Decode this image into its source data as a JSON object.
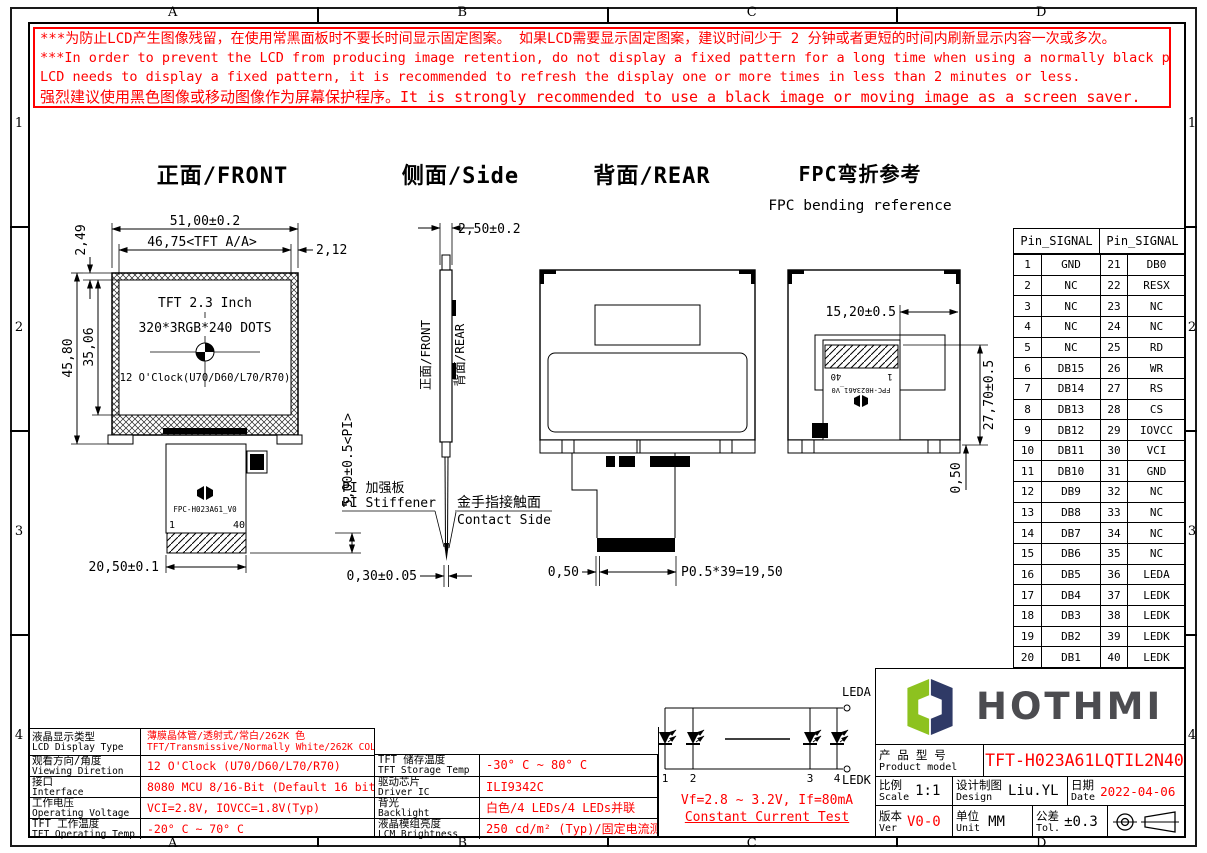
{
  "colors": {
    "red": "#ff0000",
    "black": "#000000",
    "logo_green": "#8dc21f",
    "logo_navy": "#2f3a66",
    "logo_text": "#4c4c50"
  },
  "frame": {
    "cols": [
      "A",
      "B",
      "C",
      "D"
    ],
    "rows": [
      "1",
      "2",
      "3",
      "4"
    ]
  },
  "warning": {
    "line1": "***为防止LCD产生图像残留，在使用常黑面板时不要长时间显示固定图案。 如果LCD需要显示固定图案，建议时间少于 2 分钟或者更短的时间内刷新显示内容一次或多次。",
    "line2": "***In order to prevent the LCD from producing image retention, do not display a fixed pattern for a long time when using a normally black panel. If the",
    "line3": " LCD needs to display a fixed pattern, it is recommended to refresh the display one or more times in less than 2 minutes or less.",
    "line4": "强烈建议使用黑色图像或移动图像作为屏幕保护程序。It is strongly recommended to use a black image or moving image as a screen saver."
  },
  "views": {
    "front": {
      "title": "正面/FRONT",
      "dim_width": "51,00±0.2",
      "dim_aa_width": "46,75<TFT A/A>",
      "dim_right": "2,12",
      "dim_top": "2,49",
      "dim_height": "45,80",
      "dim_aa_height": "35,06",
      "dim_fpc_width": "20,50±0.1",
      "dim_pi": "5,00±0.5<PI>",
      "panel_line1": "TFT 2.3 Inch",
      "panel_line2": "320*3RGB*240 DOTS",
      "panel_line3": "12 O'Clock(U70/D60/L70/R70)",
      "fpc_label": "FPC-H023A61_V0",
      "pin_first": "1",
      "pin_last": "40"
    },
    "side": {
      "title": "侧面/Side",
      "dim_thickness": "2,50±0.2",
      "label_front": "正面/FRONT",
      "label_rear": "背面/REAR",
      "stiffener_cn": "PI 加强板",
      "stiffener_en": "PI Stiffener",
      "contact_cn": "金手指接触面",
      "contact_en": "Contact Side",
      "dim_fpc_thickness": "0,30±0.05"
    },
    "rear": {
      "title": "背面/REAR",
      "dim_pin_offset": "0,50",
      "dim_pitch": "P0.5*39=19,50"
    },
    "fpc": {
      "title": "FPC弯折参考",
      "subtitle": "FPC bending reference",
      "dim_bend_width": "15,20±0.5",
      "dim_bend_height": "27,70±0.5",
      "dim_gap": "0,50",
      "fpc_label": "FPC-H023A61_V0",
      "pin_first": "1",
      "pin_last": "40"
    }
  },
  "pin_table": {
    "header_left": "Pin_SIGNAL",
    "header_right": "Pin_SIGNAL",
    "rows": [
      [
        "1",
        "GND",
        "21",
        "DB0"
      ],
      [
        "2",
        "NC",
        "22",
        "RESX"
      ],
      [
        "3",
        "NC",
        "23",
        "NC"
      ],
      [
        "4",
        "NC",
        "24",
        "NC"
      ],
      [
        "5",
        "NC",
        "25",
        "RD"
      ],
      [
        "6",
        "DB15",
        "26",
        "WR"
      ],
      [
        "7",
        "DB14",
        "27",
        "RS"
      ],
      [
        "8",
        "DB13",
        "28",
        "CS"
      ],
      [
        "9",
        "DB12",
        "29",
        "IOVCC"
      ],
      [
        "10",
        "DB11",
        "30",
        "VCI"
      ],
      [
        "11",
        "DB10",
        "31",
        "GND"
      ],
      [
        "12",
        "DB9",
        "32",
        "NC"
      ],
      [
        "13",
        "DB8",
        "33",
        "NC"
      ],
      [
        "14",
        "DB7",
        "34",
        "NC"
      ],
      [
        "15",
        "DB6",
        "35",
        "NC"
      ],
      [
        "16",
        "DB5",
        "36",
        "LEDA"
      ],
      [
        "17",
        "DB4",
        "37",
        "LEDK"
      ],
      [
        "18",
        "DB3",
        "38",
        "LEDK"
      ],
      [
        "19",
        "DB2",
        "39",
        "LEDK"
      ],
      [
        "20",
        "DB1",
        "40",
        "LEDK"
      ]
    ]
  },
  "spec_table": {
    "left": [
      {
        "cn": "液晶显示类型",
        "en": "LCD Display Type",
        "value": "薄膜晶体管/透射式/常白/262K 色",
        "value2": "TFT/Transmissive/Normally White/262K COLOR"
      },
      {
        "cn": "观看方向/角度",
        "en": "Viewing Diretion",
        "value": "12 O'Clock (U70/D60/L70/R70)"
      },
      {
        "cn": "接口",
        "en": "Interface",
        "value": "8080 MCU 8/16-Bit (Default 16 bit)"
      },
      {
        "cn": "工作电压",
        "en": "Operating Voltage",
        "value": "VCI=2.8V, IOVCC=1.8V(Typ)"
      },
      {
        "cn": "TFT 工作温度",
        "en": "TFT Operating Temp",
        "value": "-20° C ~ 70° C"
      }
    ],
    "middle": [
      {
        "cn": "TFT 储存温度",
        "en": "TFT Storage Temp",
        "value": "-30° C ~ 80° C"
      },
      {
        "cn": "驱动芯片",
        "en": "Driver IC",
        "value": "ILI9342C"
      },
      {
        "cn": "背光",
        "en": "Backlight",
        "value": "白色/4 LEDs/4 LEDs并联"
      },
      {
        "cn": "液晶模组亮度",
        "en": "LCM Brightness",
        "value": "250 cd/m² (Typ)/固定电流测试"
      }
    ],
    "test": {
      "line1": "Vf=2.8 ~ 3.2V, If=80mA",
      "line2": "Constant Current Test"
    }
  },
  "led_circuit": {
    "anode": "LEDA",
    "cathode": "LEDK",
    "led_numbers": [
      "1",
      "2",
      "3",
      "4"
    ]
  },
  "logo": {
    "text": "HOTHMI"
  },
  "title_block": {
    "product_cn": "产 品 型 号",
    "product_en": "Product model",
    "product_value": "TFT-H023A61LQTIL2N40",
    "scale_cn": "比例",
    "scale_en": "Scale",
    "scale_value": "1:1",
    "design_cn": "设计制图",
    "design_en": "Design",
    "design_value": "Liu.YL",
    "date_cn": "日期",
    "date_en": "Date",
    "date_value": "2022-04-06",
    "ver_cn": "版本",
    "ver_en": "Ver",
    "ver_value": "V0-0",
    "unit_cn": "单位",
    "unit_en": "Unit",
    "unit_value": "MM",
    "tol_cn": "公差",
    "tol_en": "Tol.",
    "tol_value": "±0.3"
  }
}
